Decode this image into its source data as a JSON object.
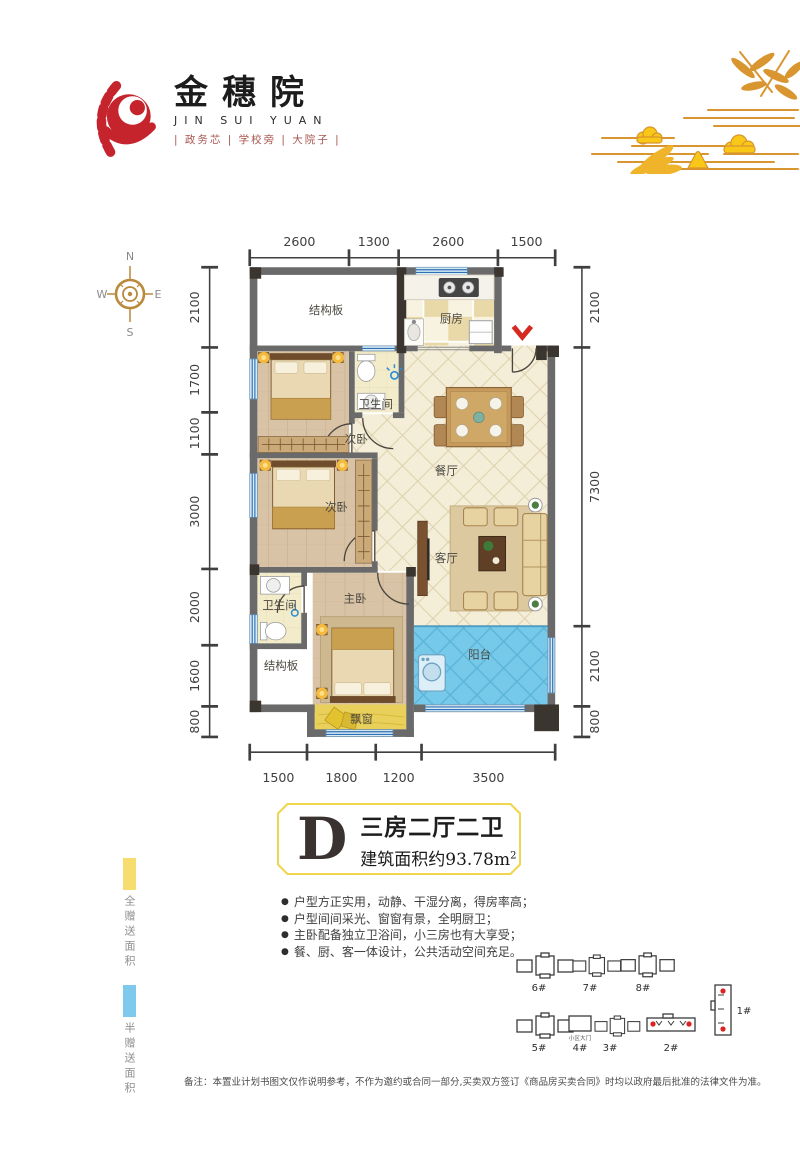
{
  "brand": {
    "name": "金穗院",
    "name_en": "JIN SUI YUAN",
    "tagline": "| 政务芯 | 学校旁 | 大院子 |"
  },
  "compass": {
    "n": "N",
    "e": "E",
    "s": "S",
    "w": "W"
  },
  "floorplan": {
    "rooms": {
      "slab_top": "结构板",
      "kitchen": "厨房",
      "bath1": "卫生间",
      "bed_a": "次卧",
      "bed_b": "次卧",
      "dining": "餐厅",
      "living": "客厅",
      "master": "主卧",
      "bath2": "卫生间",
      "slab_bottom": "结构板",
      "balcony": "阳台",
      "bay_window": "飘窗"
    },
    "dims": {
      "top": [
        "2600",
        "1300",
        "2600",
        "1500"
      ],
      "left": [
        "2100",
        "1700",
        "1100",
        "3000",
        "2000",
        "1600",
        "800"
      ],
      "right": [
        "2100",
        "7300",
        "2100",
        "800"
      ],
      "bottom": [
        "1500",
        "1800",
        "1200",
        "3500"
      ]
    }
  },
  "unit": {
    "letter": "D",
    "layout": "三房二厅二卫",
    "area": "建筑面积约93.78m",
    "area_sup": "2"
  },
  "features": [
    "户型方正实用，动静、干湿分离，得房率高；",
    "户型间间采光、窗窗有景，全明厨卫；",
    "主卧配备独立卫浴间，小三房也有大享受；",
    "餐、厨、客一体设计，公共活动空间充足。"
  ],
  "legend": {
    "full": {
      "label": "全赠送面积",
      "color": "#f6dd6d"
    },
    "half": {
      "label": "半赠送面积",
      "color": "#7fc9ec"
    }
  },
  "siteplan": {
    "gate": "小区大门",
    "b1": "1#",
    "b2": "2#",
    "b3": "3#",
    "b4": "4#",
    "b5": "5#",
    "b6": "6#",
    "b7": "7#",
    "b8": "8#"
  },
  "disclaimer": "备注：本置业计划书图文仅作说明参考，不作为邀约或合同一部分,买卖双方签订《商品房买卖合同》时均以政府最后批准的法律文件为准。"
}
